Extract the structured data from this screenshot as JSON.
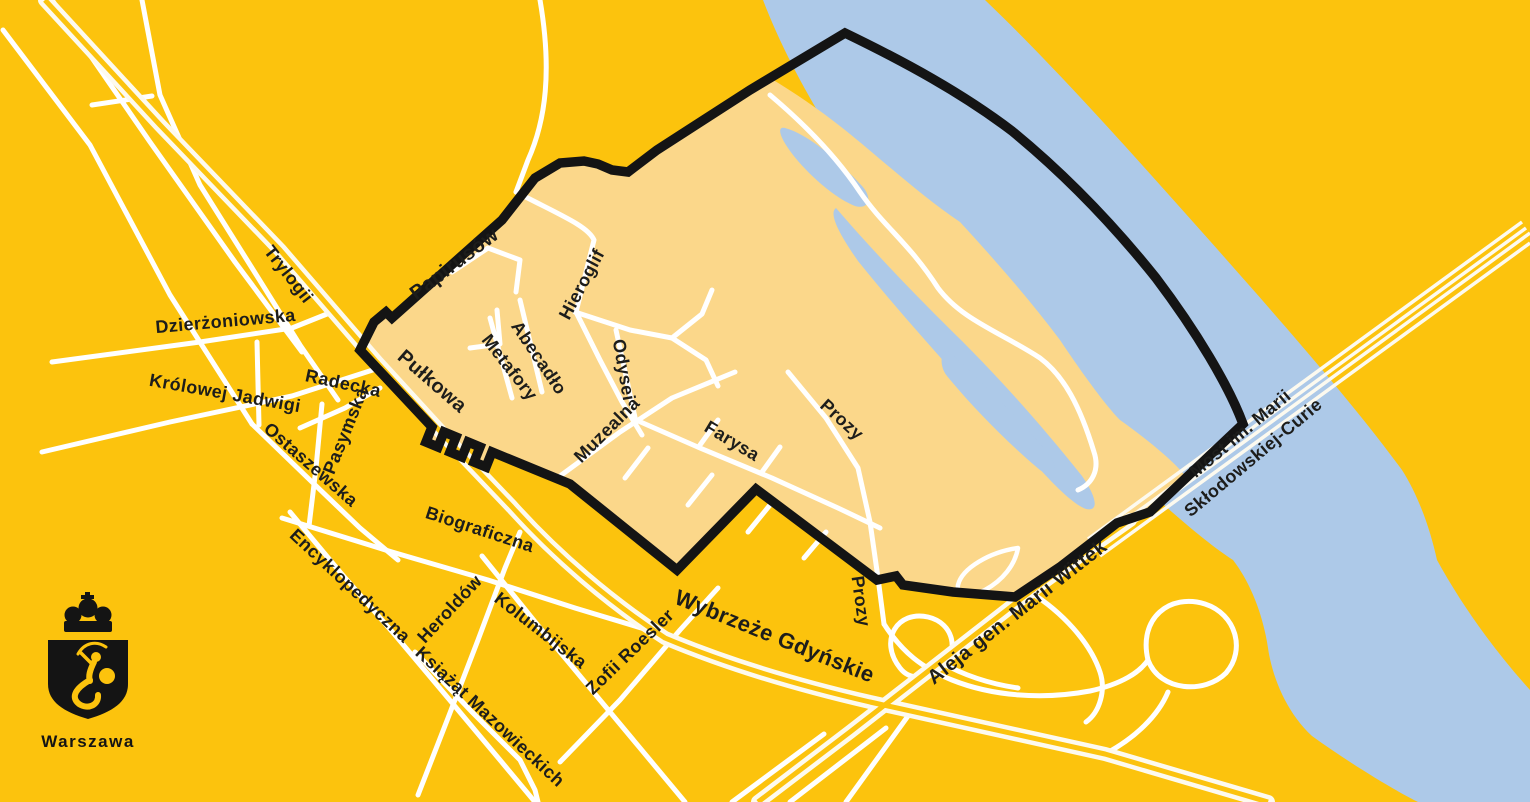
{
  "logo": {
    "city": "Warszawa"
  },
  "map": {
    "colors": {
      "land": "#FCC30D",
      "district": "#FBD78A",
      "river": "#ADC9E8",
      "boundary": "#141414",
      "road": "#FFFFFF",
      "road_cream": "#FDFAEF",
      "label": "#1D1D1B"
    },
    "river_path": "M 763,0 L 985,0 C 1050,62 1122,142 1202,232 C 1282,322 1352,402 1402,470 C 1418,495 1430,528 1437,560 C 1460,602 1492,648 1530,690 L 1530,802 L 1418,802 C 1392,789 1348,762 1312,736 C 1286,712 1272,676 1268,648 C 1263,614 1250,582 1233,560 C 1208,544 1168,510 1118,463 C 1058,406 988,330 923,258 C 868,196 798,92 763,0 Z",
    "district_path": "M 432,427 L 426,442 L 438,447 L 444,432 L 456,437 L 450,452 L 462,457 L 468,442 L 480,447 L 474,462 L 486,467 L 492,452 L 570,484 L 677,570 L 756,489 L 877,580 L 896,576 L 903,585 L 953,592 L 1015,597 L 1060,567 L 1117,523 L 1150,512 L 1187,478 C 1175,462 1148,440 1120,420 C 1105,405 1080,370 1060,340 C 1030,300 995,260 960,222 C 920,195 880,158 845,130 C 820,110 795,93 770,78 L 657,150 L 628,172 L 612,170 L 598,164 L 584,161 L 560,163 L 535,178 L 502,220 L 392,318 L 386,312 L 374,322 L 360,350 Z",
    "boundary_path": "M 432,427 L 426,442 L 438,447 L 444,432 L 456,437 L 450,452 L 462,457 L 468,442 L 480,447 L 474,462 L 486,467 L 492,452 L 570,484 L 677,570 L 756,489 L 877,580 L 896,576 L 903,585 L 953,592 L 1015,597 L 1060,567 L 1117,523 L 1150,512 L 1243,424 C 1229,386 1196,331 1156,278 C 1112,223 1062,172 1012,131 C 962,93 905,62 845,33 L 750,90 L 657,150 L 628,172 L 612,170 L 598,164 L 584,161 L 560,163 L 535,178 L 502,220 L 392,318 L 386,312 L 374,322 L 360,350 Z",
    "channel_paths": [
      "M 785,128 C 808,134 838,160 862,186 C 873,198 869,210 855,206 C 830,196 800,166 788,148 C 781,138 776,126 785,128 Z",
      "M 836,208 C 872,250 916,296 962,341 C 1002,381 1042,426 1082,476 C 1096,496 1100,512 1086,509 C 1066,502 1028,456 993,416 C 948,366 898,311 858,261 C 844,241 827,214 836,208 Z",
      "M 950,352 C 986,386 1022,421 1050,456 C 1060,469 1053,479 1040,470 C 1011,446 974,409 947,376 C 938,365 941,347 950,352 Z"
    ],
    "sand_trail_path": "M 770,95 C 802,122 836,156 860,192 C 884,227 910,244 938,288 C 962,320 1000,332 1040,358 C 1064,376 1080,406 1094,452 C 1100,470 1092,484 1078,490",
    "sand_loop_path": "M 1018,548 C 990,552 962,568 958,585 C 956,596 970,598 985,590 C 1003,580 1015,565 1018,548 Z",
    "roads": {
      "major": [
        {
          "id": "pulkowa-wybrzeze-gdynskie",
          "d": "M 45,0 L 160,125 L 280,250 L 375,360 L 450,442 L 512,507 C 556,556 610,602 665,638 C 722,662 792,684 870,702 C 950,720 1030,738 1105,754 L 1268,802"
        },
        {
          "id": "aleja-wittek",
          "d": "M 758,802 L 850,732 L 940,662 L 1030,592 L 1096,544 L 1130,520"
        }
      ],
      "bridge": [
        "M 1088,539 L 1522,222",
        "M 1092,545 L 1526,228",
        "M 1096,550 L 1530,233",
        "M 1100,556 L 1530,243"
      ],
      "ramps": [
        "M 900,668 C 878,640 898,610 928,617 C 954,623 960,652 941,668 C 927,679 910,681 900,668 Z",
        "M 1148,660 C 1138,618 1170,593 1205,604 C 1236,614 1246,650 1226,673 C 1205,694 1160,692 1148,660 Z",
        "M 884,624 C 902,652 922,668 952,680 C 992,696 1042,700 1090,691 C 1122,684 1140,672 1148,660",
        "M 1105,754 C 1135,738 1158,716 1168,692",
        "M 1030,592 C 1062,612 1090,642 1100,672 C 1106,690 1100,712 1086,722",
        "M 940,662 C 965,676 990,684 1018,688"
      ],
      "minor": [
        {
          "id": "road-nw-1",
          "d": "M 52,0 L 150,142 L 235,262 L 302,352"
        },
        {
          "id": "road-nw-2",
          "d": "M 3,30 L 90,145 L 170,295 L 252,424"
        },
        {
          "id": "road-nw-link",
          "d": "M 92,105 L 152,96"
        },
        {
          "id": "trylogii-road",
          "d": "M 142,0 L 160,95 L 200,185 L 252,268 L 300,345 L 338,400"
        },
        {
          "id": "dzierzoniowska-road",
          "d": "M 52,362 L 200,342 L 292,328 L 332,312"
        },
        {
          "id": "connector-road",
          "d": "M 257,342 L 259,425"
        },
        {
          "id": "krolowej-jadwigi-road",
          "d": "M 42,452 L 170,422 L 292,396 L 382,367"
        },
        {
          "id": "radecka-road",
          "d": "M 300,428 L 345,408 L 380,388"
        },
        {
          "id": "pasymska-road",
          "d": "M 322,404 L 316,468 L 309,526"
        },
        {
          "id": "ostaszewska-road",
          "d": "M 252,424 L 312,482 L 360,528 L 398,560"
        },
        {
          "id": "feeder-road",
          "d": "M 540,0 C 552,70 546,120 528,160 L 516,192"
        },
        {
          "id": "hieroglif-road",
          "d": "M 516,192 C 560,215 588,226 594,240 L 576,312 L 600,360 L 622,402 L 642,435"
        },
        {
          "id": "papirusow-stub",
          "d": "M 452,272 L 488,248 L 520,260 L 516,292"
        },
        {
          "id": "l-stub",
          "d": "M 470,348 L 500,344 L 497,310"
        },
        {
          "id": "metafory-road",
          "d": "M 490,318 L 512,398"
        },
        {
          "id": "abecadlo-road",
          "d": "M 520,300 L 542,392"
        },
        {
          "id": "odysei-road",
          "d": "M 616,330 L 636,422"
        },
        {
          "id": "muzealna-road",
          "d": "M 560,476 L 620,432 L 672,398 L 735,372"
        },
        {
          "id": "farysa-road",
          "d": "M 636,420 L 700,448 L 772,478 L 838,508 L 880,528"
        },
        {
          "id": "prozy-road",
          "d": "M 788,372 L 826,418 L 858,468 L 870,522 L 878,578 L 884,624"
        },
        {
          "id": "east-spur-1",
          "d": "M 575,312 L 630,330 L 672,338"
        },
        {
          "id": "east-spur-2",
          "d": "M 672,338 L 702,314 L 712,290"
        },
        {
          "id": "east-spur-3",
          "d": "M 672,338 L 706,360 L 718,386"
        },
        {
          "id": "stub-1",
          "d": "M 648,448 L 625,478"
        },
        {
          "id": "stub-2",
          "d": "M 712,475 L 688,505"
        },
        {
          "id": "stub-3",
          "d": "M 770,505 L 748,532"
        },
        {
          "id": "stub-4",
          "d": "M 826,532 L 804,558"
        },
        {
          "id": "stub-5",
          "d": "M 700,445 L 718,420"
        },
        {
          "id": "stub-6",
          "d": "M 762,472 L 780,447"
        },
        {
          "id": "biograficzna-road",
          "d": "M 282,518 L 392,552 L 488,580 L 575,608 L 648,630"
        },
        {
          "id": "encyklopedyczna-road",
          "d": "M 290,512 L 340,572 L 395,635 L 448,698 L 500,760 L 535,802"
        },
        {
          "id": "heroldow-road",
          "d": "M 418,795 L 448,718 L 478,640 L 505,568 L 520,532"
        },
        {
          "id": "kolumbijska-road",
          "d": "M 482,556 L 540,628 L 600,700 L 650,760 L 685,802"
        },
        {
          "id": "zofii-roesler-road",
          "d": "M 560,762 L 620,700 L 680,630 L 718,588"
        },
        {
          "id": "ksiazat-road",
          "d": "M 415,652 L 472,712 L 520,760 L 535,790 L 538,802"
        },
        {
          "id": "south-lane-1",
          "d": "M 790,802 L 886,728"
        },
        {
          "id": "south-lane-2",
          "d": "M 732,802 L 824,734"
        },
        {
          "id": "south-lane-3",
          "d": "M 846,802 L 908,716"
        }
      ]
    },
    "labels": [
      {
        "id": "trylogii",
        "text": "Trylogii",
        "x": 284,
        "y": 278,
        "rotate": 52,
        "size": 18
      },
      {
        "id": "dzierzoniowska",
        "text": "Dzierżoniowska",
        "x": 226,
        "y": 327,
        "rotate": -5,
        "size": 18
      },
      {
        "id": "krolowej-jadwigi",
        "text": "Królowej Jadwigi",
        "x": 224,
        "y": 399,
        "rotate": 10,
        "size": 18
      },
      {
        "id": "radecka",
        "text": "Radecka",
        "x": 342,
        "y": 389,
        "rotate": 12,
        "size": 18
      },
      {
        "id": "pasymska",
        "text": "Pasymska",
        "x": 351,
        "y": 433,
        "rotate": -68,
        "size": 18
      },
      {
        "id": "ostaszewska",
        "text": "Ostaszewska",
        "x": 307,
        "y": 469,
        "rotate": 41,
        "size": 18
      },
      {
        "id": "papirusow",
        "text": "Papirusów",
        "x": 458,
        "y": 269,
        "rotate": -37,
        "size": 20
      },
      {
        "id": "pulkowa",
        "text": "Pułkowa",
        "x": 428,
        "y": 386,
        "rotate": 41,
        "size": 20
      },
      {
        "id": "hieroglif",
        "text": "Hieroglif",
        "x": 587,
        "y": 287,
        "rotate": -62,
        "size": 18
      },
      {
        "id": "abecadlo",
        "text": "Abecadło",
        "x": 534,
        "y": 361,
        "rotate": 56,
        "size": 18
      },
      {
        "id": "metafory",
        "text": "Metafory",
        "x": 505,
        "y": 371,
        "rotate": 52,
        "size": 18
      },
      {
        "id": "odysei",
        "text": "Odysei",
        "x": 618,
        "y": 371,
        "rotate": 80,
        "size": 18
      },
      {
        "id": "muzealna",
        "text": "Muzealna",
        "x": 611,
        "y": 434,
        "rotate": -45,
        "size": 18
      },
      {
        "id": "farysa",
        "text": "Farysa",
        "x": 729,
        "y": 446,
        "rotate": 31,
        "size": 18
      },
      {
        "id": "prozy-north",
        "text": "Prozy",
        "x": 838,
        "y": 424,
        "rotate": 42,
        "size": 18
      },
      {
        "id": "prozy-south",
        "text": "Prozy",
        "x": 855,
        "y": 602,
        "rotate": 82,
        "size": 18
      },
      {
        "id": "biograficzna",
        "text": "Biograficzna",
        "x": 478,
        "y": 535,
        "rotate": 18,
        "size": 18
      },
      {
        "id": "encyklopedyczna",
        "text": "Encyklopedyczna",
        "x": 346,
        "y": 590,
        "rotate": 43,
        "size": 18
      },
      {
        "id": "heroldow",
        "text": "Heroldów",
        "x": 454,
        "y": 613,
        "rotate": -47,
        "size": 18
      },
      {
        "id": "kolumbijska",
        "text": "Kolumbijska",
        "x": 537,
        "y": 635,
        "rotate": 38,
        "size": 18
      },
      {
        "id": "zofii-roesler",
        "text": "Zofii Roesler",
        "x": 634,
        "y": 656,
        "rotate": -44,
        "size": 18
      },
      {
        "id": "ksiazat",
        "text": "Książąt Mazowieckich",
        "x": 486,
        "y": 721,
        "rotate": 43,
        "size": 18
      },
      {
        "id": "wybrzeze",
        "text": "Wybrzeże Gdyńskie",
        "x": 772,
        "y": 643,
        "rotate": 22,
        "size": 22
      },
      {
        "id": "wittek",
        "text": "Aleja gen. Marii Wittek",
        "x": 1021,
        "y": 617,
        "rotate": -38,
        "size": 20
      },
      {
        "id": "most-line-1",
        "text": "Most im. Marii",
        "x": 1244,
        "y": 438,
        "rotate": -40,
        "size": 18
      },
      {
        "id": "most-line-2",
        "text": "Skłodowskiej-Curie",
        "x": 1257,
        "y": 462,
        "rotate": -40,
        "size": 18
      }
    ]
  }
}
